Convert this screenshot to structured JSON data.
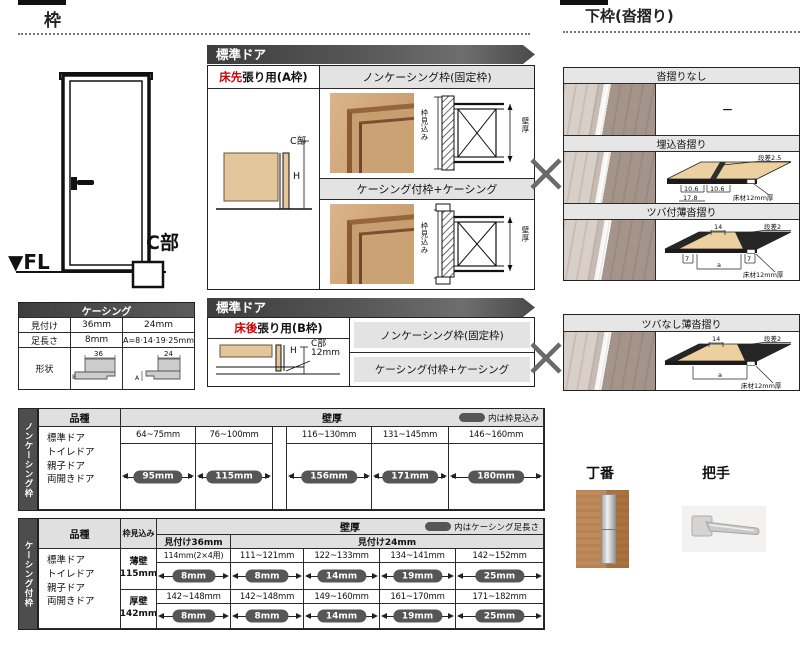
{
  "titles": {
    "left": "枠",
    "right": "下枠(沓摺り)"
  },
  "elevation": {
    "fl": "▼FL",
    "c": "C部"
  },
  "banners": {
    "a": "標準ドア",
    "b": "標準ドア"
  },
  "secA": {
    "head_red": "床先",
    "head_rest": "張り用(A枠)",
    "c": "C部",
    "h": "H",
    "row1": "ノンケーシング枠(固定枠)",
    "row2": "ケーシング付枠+ケーシング",
    "mikomi": "枠見込み",
    "kabe": "壁厚"
  },
  "secB": {
    "head_red": "床後",
    "head_rest": "張り用(B枠)",
    "c": "C部",
    "h": "H",
    "d12": "12mm",
    "row1": "ノンケーシング枠(固定枠)",
    "row2": "ケーシング付枠+ケーシング"
  },
  "thresholds": {
    "none": {
      "title": "沓摺りなし",
      "dash": "−"
    },
    "umekomi": {
      "title": "埋込沓摺り",
      "step": "段差2.5",
      "dl": "10.6",
      "dr": "10.6",
      "total": "17.8",
      "floor": "床材12mm厚"
    },
    "tsuba": {
      "title": "ツバ付薄沓摺り",
      "w": "14",
      "step": "段差2",
      "l7": "7",
      "a": "a",
      "r7": "7",
      "floor": "床材12mm厚"
    },
    "tsubanashi": {
      "title": "ツバなし薄沓摺り",
      "w": "14",
      "step": "段差2",
      "a": "a",
      "floor": "床材12mm厚"
    }
  },
  "casingSpec": {
    "title": "ケーシング",
    "mitsuke": {
      "label": "見付け",
      "v36": "36mm",
      "v24": "24mm"
    },
    "ashi": {
      "label": "足長さ",
      "v36": "8mm",
      "v24": "A=8·14·19·25mm"
    },
    "shape": {
      "label": "形状",
      "s1top": "36",
      "s1side": "8",
      "s2top": "24",
      "s2side": "A"
    }
  },
  "t1": {
    "side": "ノンケーシング枠",
    "hinshu": "品種",
    "kabeatsu": "壁厚",
    "note": "内は枠見込み",
    "doors": [
      "標準ドア",
      "トイレドア",
      "親子ドア",
      "両開きドア"
    ],
    "cols": [
      {
        "range": "64~75mm",
        "v": "95mm"
      },
      {
        "range": "76~100mm",
        "v": "115mm"
      },
      {
        "range": "116~130mm",
        "v": "156mm"
      },
      {
        "range": "131~145mm",
        "v": "171mm"
      },
      {
        "range": "146~160mm",
        "v": "180mm"
      }
    ]
  },
  "t2": {
    "side": "ケーシング付枠",
    "hinshu": "品種",
    "mikomi": "枠見込み",
    "kabeatsu": "壁厚",
    "note": "内はケーシング足長さ",
    "g36": "見付け36mm",
    "g24": "見付け24mm",
    "doors": [
      "標準ドア",
      "トイレドア",
      "親子ドア",
      "両開きドア"
    ],
    "thin": {
      "type": "薄壁",
      "dim": "115mm",
      "cells": [
        {
          "range": "114mm(2×4用)",
          "v": "8mm"
        },
        {
          "range": "111~121mm",
          "v": "8mm"
        },
        {
          "range": "122~133mm",
          "v": "14mm"
        },
        {
          "range": "134~141mm",
          "v": "19mm"
        },
        {
          "range": "142~152mm",
          "v": "25mm"
        }
      ]
    },
    "thick": {
      "type": "厚壁",
      "dim": "142mm",
      "cells": [
        {
          "range": "142~148mm",
          "v": "8mm"
        },
        {
          "range": "142~148mm",
          "v": "8mm"
        },
        {
          "range": "149~160mm",
          "v": "14mm"
        },
        {
          "range": "161~170mm",
          "v": "19mm"
        },
        {
          "range": "171~182mm",
          "v": "25mm"
        }
      ]
    }
  },
  "hardware": {
    "hinge": "丁番",
    "handle": "把手"
  }
}
